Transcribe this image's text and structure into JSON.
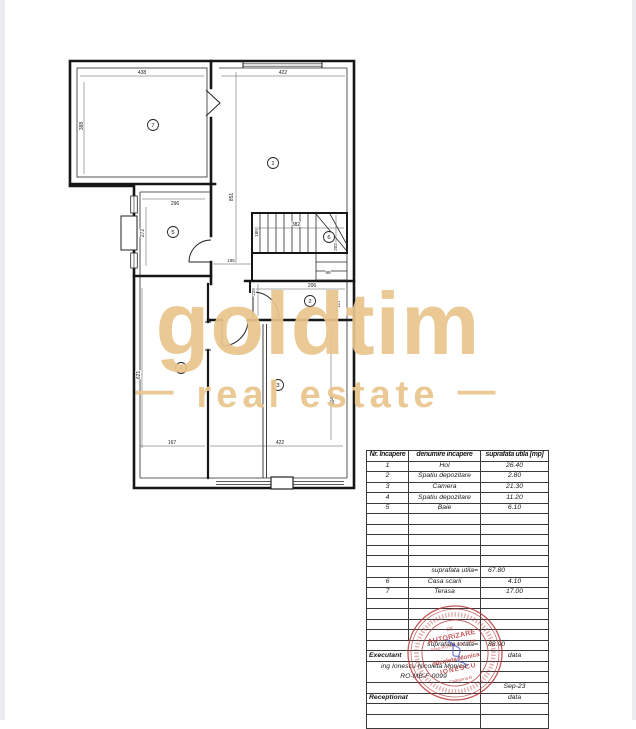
{
  "watermark": {
    "brand": "goldtim",
    "tagline": "real estate",
    "dash": "—",
    "color": "#e9c58d"
  },
  "floor_plan": {
    "rooms": {
      "r1": "1",
      "r2": "2",
      "r3": "3",
      "r4": "4",
      "r5": "5",
      "r6": "6",
      "r7": "7"
    },
    "dims": {
      "room7_width": "438",
      "room1_width": "422",
      "room7_height": "388",
      "right_side_height": "851",
      "room5_width": "296",
      "room5_height": "272",
      "hall_width": "195",
      "stairs_length": "382",
      "stairs_width": "180",
      "stairs_side": "202",
      "stair_step": "99",
      "corridor_height": "229",
      "room2_width": "206",
      "room2_height": "117",
      "room4_height": "621",
      "room4_width": "167",
      "room3_width": "422",
      "room3_height": "504"
    }
  },
  "table": {
    "header": {
      "col1": "Nr. Incapere",
      "col2": "denumire incapere",
      "col3": "suprafata utila [mp]"
    },
    "rows": [
      {
        "nr": "1",
        "name": "Hol",
        "area": "26.40"
      },
      {
        "nr": "2",
        "name": "Spatiu depozitare",
        "area": "2.80"
      },
      {
        "nr": "3",
        "name": "Camera",
        "area": "21.30"
      },
      {
        "nr": "4",
        "name": "Spatiu depozitare",
        "area": "11.20"
      },
      {
        "nr": "5",
        "name": "Baie",
        "area": "6.10"
      }
    ],
    "subtotal": {
      "label": "suprafata utila=",
      "value": "67.80"
    },
    "rows2": [
      {
        "nr": "6",
        "name": "Casa scarii",
        "area": "4.10"
      },
      {
        "nr": "7",
        "name": "Terasa",
        "area": "17.00"
      }
    ],
    "total": {
      "label": "suprafata totala=",
      "value": "88.90"
    },
    "footer": {
      "executant": "Executant",
      "data1": "data",
      "engineer": "ing  Ionescu Nicoleta Monica",
      "license": "RO-MB-F-0099",
      "date": "Sep-23",
      "receptionat": "Receptionat",
      "data2": "data"
    }
  },
  "stamp": {
    "color": "#b73535",
    "l1": "DE",
    "l2": "AUTORIZARE",
    "l3": "Seria RO-MB-F, nr. 0099",
    "l4": "Nicoleta Monica",
    "l5": "IONESCU",
    "l6": "Categoria B"
  }
}
